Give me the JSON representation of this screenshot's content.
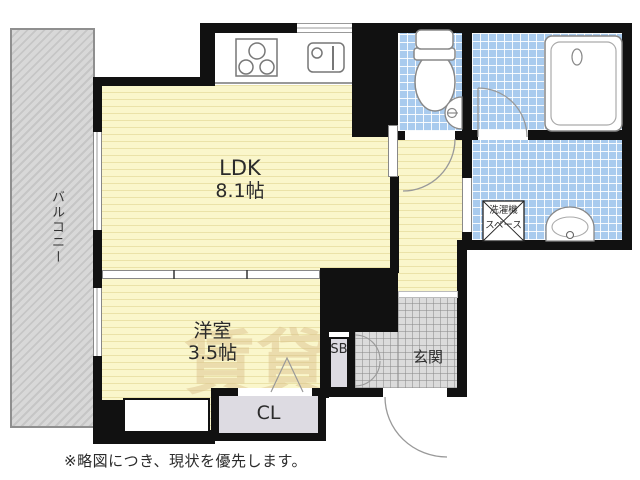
{
  "floor_plan": {
    "rooms": {
      "ldk": {
        "label": "LDK",
        "size": "8.1帖"
      },
      "western_room": {
        "label": "洋室",
        "size": "3.5帖"
      },
      "entrance": {
        "label": "玄関"
      },
      "balcony": {
        "label": "バルコニー"
      },
      "closet": {
        "label": "CL"
      },
      "shoe_box": {
        "label": "SB"
      },
      "washer_space": {
        "label_line1": "洗濯機",
        "label_line2": "スペース"
      }
    },
    "fixtures": [
      "stove-icon",
      "kitchen-sink-icon",
      "toilet-icon",
      "hand-basin-icon",
      "bathtub-icon",
      "wash-basin-icon",
      "washing-machine-space-icon",
      "door-swing-arc",
      "closet-door-mark"
    ],
    "note": "※略図につき、現状を優先します。",
    "watermark": "賃貸",
    "colors": {
      "room_yellow": "#FAF6CB",
      "tatami_stripe": "#DED18C",
      "tile_blue": "#A9CBEE",
      "entrance_gray": "#DBDBDB",
      "balcony_gray": "#D2D2D2",
      "wall_black": "#111111",
      "cabinet_gray": "#DDDBE2",
      "watermark_tan": "#D9BE8A"
    }
  }
}
